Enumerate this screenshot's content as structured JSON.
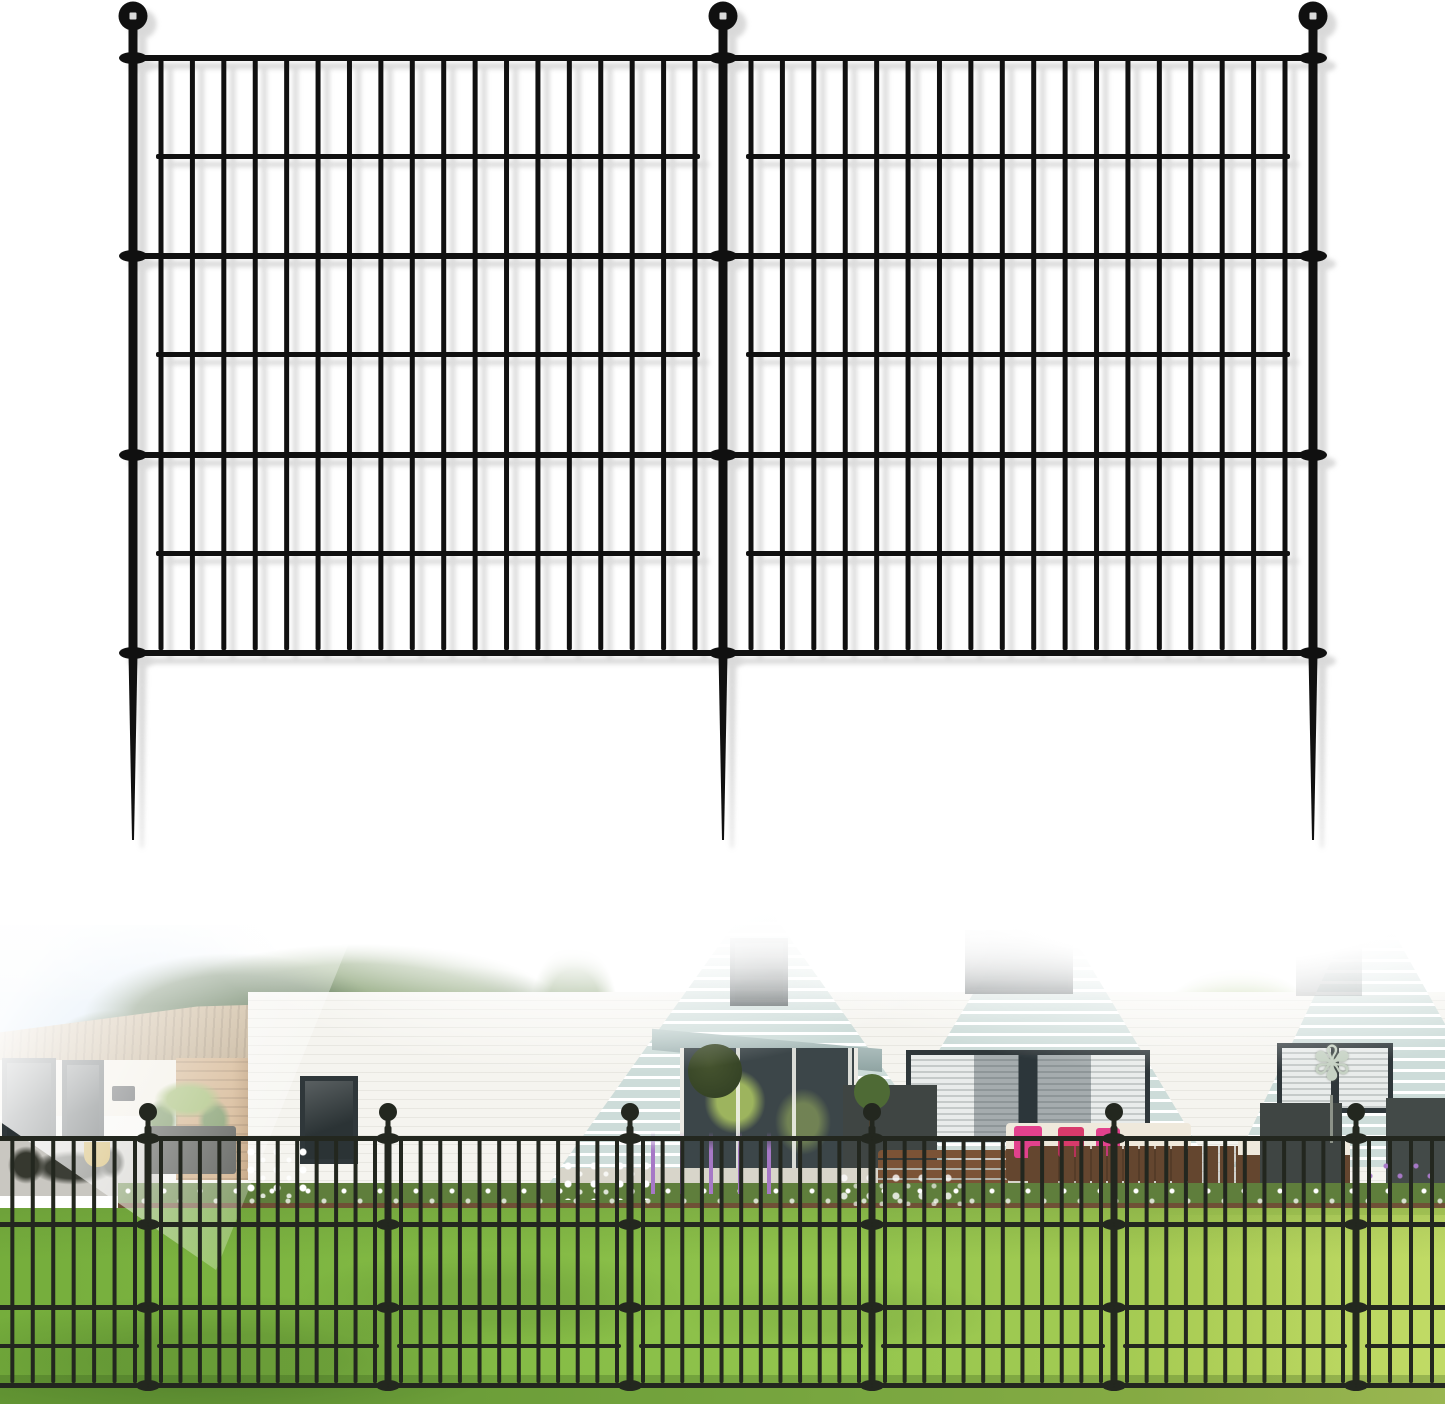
{
  "meta": {
    "description": "Product image: two-panel black metal no-dig garden border fence with ball-top stakes, shown above a lifestyle photo of the fence installed on a lawn in front of a white brick house with seafoam gables",
    "background": "#ffffff"
  },
  "palette": {
    "fence": "#101010",
    "fenceShadow": "#b5b5b5",
    "photoFence": "#23271f",
    "sky1": "#a3c7e8",
    "sky2": "#cfe2f4",
    "treeDark": "#3c5a32",
    "treeMid": "#5d7f41",
    "treeLight": "#8fae55",
    "treeYellow": "#b9c966",
    "roofTan1": "#c4a981",
    "roofTan2": "#a08864",
    "brick": "#c79e6e",
    "brickShade": "#a87f52",
    "wallWhite": "#f5f4ef",
    "wallCream": "#efeade",
    "siding": "#cddcd9",
    "frameDark": "#2f373a",
    "glass": "#2b3335",
    "blind1": "#e9eceb",
    "blind2": "#c5cac9",
    "awning1": "#c3d3d1",
    "awning2": "#8fa3a2",
    "entry": "#3c4649",
    "reflect": "#9db45e",
    "plantDark": "#2f3d22",
    "plantMid": "#46542f",
    "topiary": "#4e6a35",
    "path": "#d8d5ca",
    "pathL": "#c9c7c1",
    "grass1": "#75ad3c",
    "grass2": "#95c64e",
    "grass3": "#b8d45e",
    "shade": "#23461640",
    "mulch": "#6f5036",
    "foliage": "#5f7e3c",
    "wicker": "#64462f",
    "cushion": "#efe9dc",
    "wood": "#7b5336",
    "tableDark": "#3b342c",
    "pillowPink": "#e2418d",
    "pillowRed": "#d83a6b",
    "planter": "#3f4543",
    "planterDk": "#434a48",
    "lavender": "#a678c6",
    "lavenderDk": "#8659a8",
    "flowerWhite": "#ffffff",
    "potGold": "#c09a2e",
    "decoPanel": "#2d302b",
    "spinner": "#c6d2c4",
    "plaque": "#2b2f32"
  },
  "product_fence": {
    "panels": 2,
    "posts": [
      133,
      723,
      1313
    ],
    "post_width": 9,
    "post_top": 28,
    "post_bottom": 658,
    "spike_tip": 840,
    "ball": {
      "cy": 16,
      "r": 14.5,
      "highlight": true
    },
    "rails_full": [
      55,
      253,
      452,
      650
    ],
    "rails_inset": [
      154,
      352,
      551
    ],
    "rail_thickness": 6,
    "bar_width": 5,
    "bar_margin": 28,
    "bar_pitch": 31.5,
    "bar_top": 55,
    "bar_bottom": 650,
    "color": "#101010",
    "shadow": {
      "dx": 9,
      "dy": 8,
      "color": "#b5b5b5",
      "opacity": 0.5
    }
  },
  "photo": {
    "fence": {
      "posts": [
        148,
        388,
        630,
        872,
        1114,
        1356
      ],
      "post_width": 7,
      "post_top": 1126,
      "post_bottom": 1390,
      "ball": {
        "cy": 1112,
        "r": 9,
        "highlight": false
      },
      "rails_full": [
        1136,
        1222,
        1305,
        1383
      ],
      "rails_inset": [
        1344
      ],
      "rail_thickness": 5,
      "bar_width": 4,
      "bar_margin": 13,
      "bar_pitch": 19.5,
      "bar_top": 1136,
      "bar_bottom": 1383,
      "extend_left": -62,
      "extend_right": 1508,
      "color": "#23271f"
    },
    "scene": {
      "spinner_glyph": "✾",
      "left_building": "single-story white bungalow with tan shingle roof and dark french doors",
      "main_building": "white brick house with three seafoam-siding gables and dark-framed windows",
      "foreground": "green lawn with tree shadows, flower bed with mulch, black garden fence",
      "right_side": "patio with brown wicker furniture, pink pillows, dark planters, garden wind spinner"
    }
  }
}
